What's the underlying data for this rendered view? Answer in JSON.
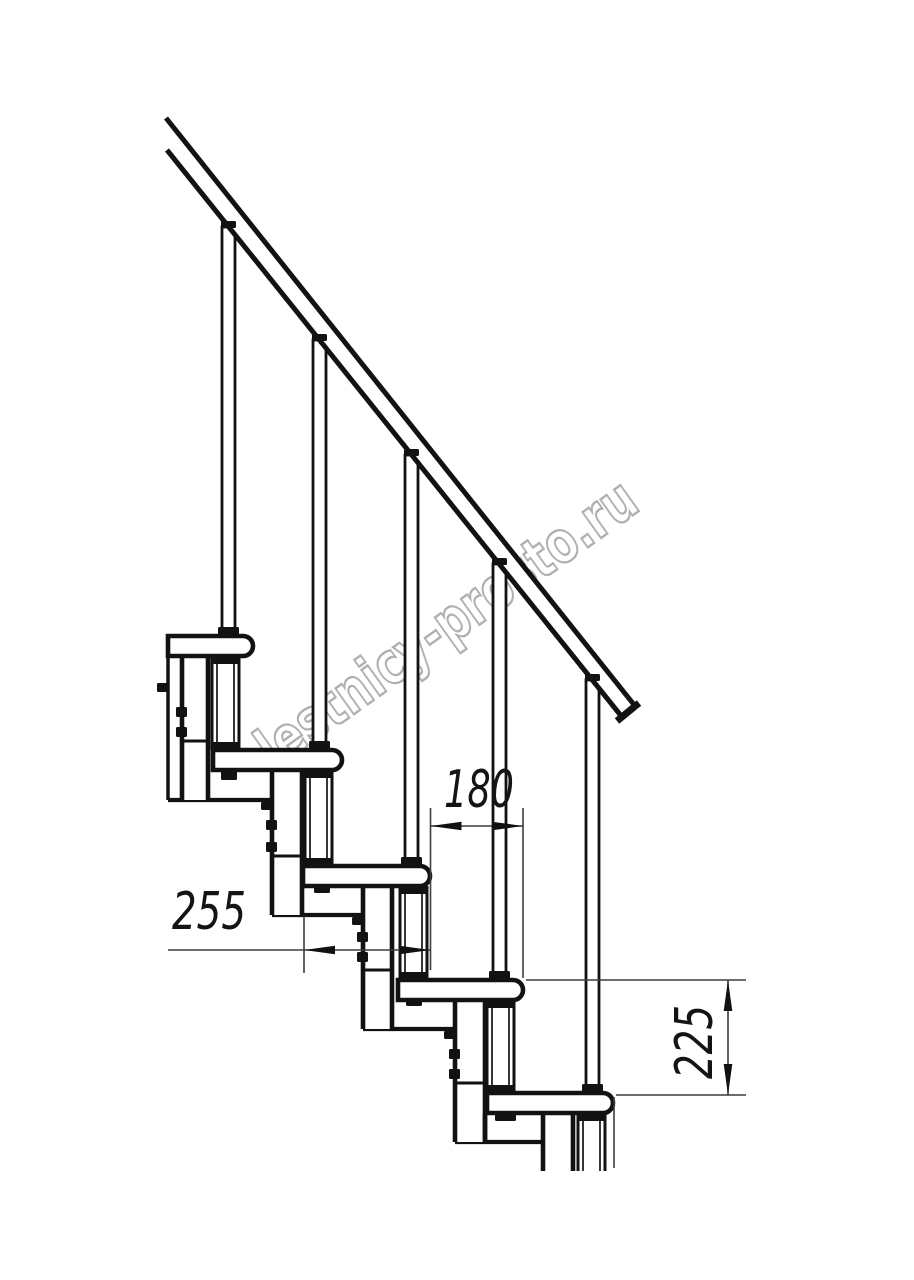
{
  "page": {
    "width": 914,
    "height": 1280,
    "background": "#ffffff"
  },
  "figure": {
    "kind": "technical-drawing",
    "subject": "modular staircase side elevation with handrail",
    "units": "mm",
    "step_run_mm": 255,
    "step_offset_mm": 180,
    "step_rise_mm": 225
  },
  "watermark": {
    "text": "lestnicy-prosto.ru",
    "color": "#a8a8a8",
    "rotation_deg": -35.5,
    "center_x": 458,
    "center_y": 640,
    "font_size": 58,
    "text_length": 452,
    "stroke_width": 2.4,
    "opacity": 0.9
  },
  "drawing": {
    "ink": "#121212",
    "dim_ink": "#3d3d3d",
    "dim_text_color": "#141414",
    "dim_font_size": 52,
    "dim_stroke": 1.6,
    "arrow_len": 31,
    "arrow_half_w": 4.3,
    "rail": {
      "band": [
        [
          166,
          118
        ],
        [
          635,
          706
        ],
        [
          622,
          717
        ],
        [
          167,
          150
        ]
      ],
      "upper_edge": [
        166,
        118,
        635,
        706
      ],
      "lower_edge": [
        167,
        150,
        622,
        717
      ],
      "end_cap": [
        617,
        721,
        639,
        703
      ],
      "edge_stroke": 5,
      "cap_stroke": 7
    },
    "treads": {
      "height": 20,
      "nose_radius": 10,
      "stroke": 4.6,
      "items": [
        {
          "x": 168,
          "y": 636,
          "w": 85
        },
        {
          "x": 213,
          "y": 750,
          "w": 129
        },
        {
          "x": 303,
          "y": 866,
          "w": 127
        },
        {
          "x": 398,
          "y": 980,
          "w": 125
        },
        {
          "x": 487,
          "y": 1093,
          "w": 126
        }
      ]
    },
    "balusters": {
      "width": 13,
      "stroke": 2.8,
      "cap_w": 15,
      "cap_h": 7,
      "clamp_w": 21,
      "clamp_h": 9,
      "items": [
        {
          "x": 222,
          "top": 227,
          "bottom": 636
        },
        {
          "x": 313,
          "top": 340,
          "bottom": 750
        },
        {
          "x": 405,
          "top": 455,
          "bottom": 866
        },
        {
          "x": 493,
          "top": 564,
          "bottom": 980
        },
        {
          "x": 586,
          "top": 680,
          "bottom": 1093
        }
      ]
    },
    "posts": {
      "width": 27,
      "stroke": 3,
      "inner_inset": 5,
      "inner_stroke": 1.7,
      "clamp_h": 8,
      "items": [
        {
          "x": 212,
          "top": 656,
          "bottom": 750,
          "open": false
        },
        {
          "x": 305,
          "top": 770,
          "bottom": 866,
          "open": false
        },
        {
          "x": 400,
          "top": 886,
          "bottom": 980,
          "open": false
        },
        {
          "x": 487,
          "top": 1000,
          "bottom": 1093,
          "open": false
        },
        {
          "x": 578,
          "top": 1113,
          "bottom": 1171,
          "open": true
        }
      ]
    },
    "columns": {
      "stroke": 4.6,
      "cross_stroke": 3,
      "bolt_w": 11,
      "bolt_h": 10,
      "items": [
        {
          "x1": 182,
          "x2": 208,
          "top": 656,
          "bottom": 800,
          "cross": 741,
          "bolt_ys": [
            707,
            727
          ],
          "corner_bolt": null,
          "open": false
        },
        {
          "x1": 272,
          "x2": 302,
          "top": 772,
          "bottom": 915,
          "cross": 856,
          "bolt_ys": [
            820,
            842
          ],
          "corner_bolt": [
            261,
            802
          ],
          "open": false
        },
        {
          "x1": 363,
          "x2": 392,
          "top": 886,
          "bottom": 1029,
          "cross": 970,
          "bolt_ys": [
            932,
            952
          ],
          "corner_bolt": [
            352,
            917
          ],
          "open": false
        },
        {
          "x1": 455,
          "x2": 485,
          "top": 1000,
          "bottom": 1142,
          "cross": 1083,
          "bolt_ys": [
            1049,
            1069
          ],
          "corner_bolt": [
            444,
            1031
          ],
          "open": false
        },
        {
          "x1": 543,
          "x2": 573,
          "top": 1113,
          "bottom": 1171,
          "cross": null,
          "bolt_ys": [],
          "corner_bolt": null,
          "open": true
        }
      ]
    },
    "plates": {
      "stroke": 4.2,
      "items": [
        [
          168,
          272,
          800
        ],
        [
          272,
          363,
          915
        ],
        [
          363,
          455,
          1029
        ],
        [
          455,
          543,
          1142
        ]
      ]
    },
    "cut_edge": {
      "line": [
        168,
        656,
        168,
        800
      ],
      "bolt": [
        157,
        683,
        11,
        9
      ],
      "stroke": 3.5
    },
    "foot_lines": [
      [
        485,
        1113,
        485,
        1142
      ]
    ],
    "stubs": [
      [
        221,
        771,
        16,
        9
      ],
      [
        314,
        885,
        16,
        8
      ],
      [
        406,
        998,
        16,
        8
      ],
      [
        495,
        1112,
        21,
        9
      ]
    ],
    "dimensions": [
      {
        "label": "180",
        "value": 180,
        "orient": "h",
        "line": [
          430.5,
          826,
          523,
          826
        ],
        "arrows": [
          {
            "tip": [
              430.5,
              826
            ],
            "dir": "left"
          },
          {
            "tip": [
              523,
              826
            ],
            "dir": "right"
          }
        ],
        "ext": [
          [
            430.5,
            808,
            430.5,
            970
          ],
          [
            523,
            808,
            523,
            978
          ]
        ],
        "text": {
          "x": 479,
          "y": 807,
          "rotate": 0,
          "length": 70
        }
      },
      {
        "label": "255",
        "value": 255,
        "orient": "h",
        "line": [
          168,
          950,
          430.5,
          950
        ],
        "arrows": [
          {
            "tip": [
              304,
              950
            ],
            "dir": "left"
          },
          {
            "tip": [
              430.5,
              950
            ],
            "dir": "right"
          }
        ],
        "ext": [
          [
            304,
            916,
            304,
            973
          ]
        ],
        "text": {
          "x": 209,
          "y": 929,
          "rotate": 0,
          "length": 74
        }
      },
      {
        "label": "225",
        "value": 225,
        "orient": "v",
        "line": [
          728,
          980,
          728,
          1095
        ],
        "arrows": [
          {
            "tip": [
              728,
              980
            ],
            "dir": "up"
          },
          {
            "tip": [
              728,
              1095
            ],
            "dir": "down"
          }
        ],
        "ext": [
          [
            526,
            980,
            746,
            980
          ],
          [
            616,
            1095,
            746,
            1095
          ],
          [
            614,
            1097,
            614,
            1168
          ]
        ],
        "text": {
          "x": 712,
          "y": 1042,
          "rotate": -90,
          "length": 74
        }
      }
    ]
  }
}
